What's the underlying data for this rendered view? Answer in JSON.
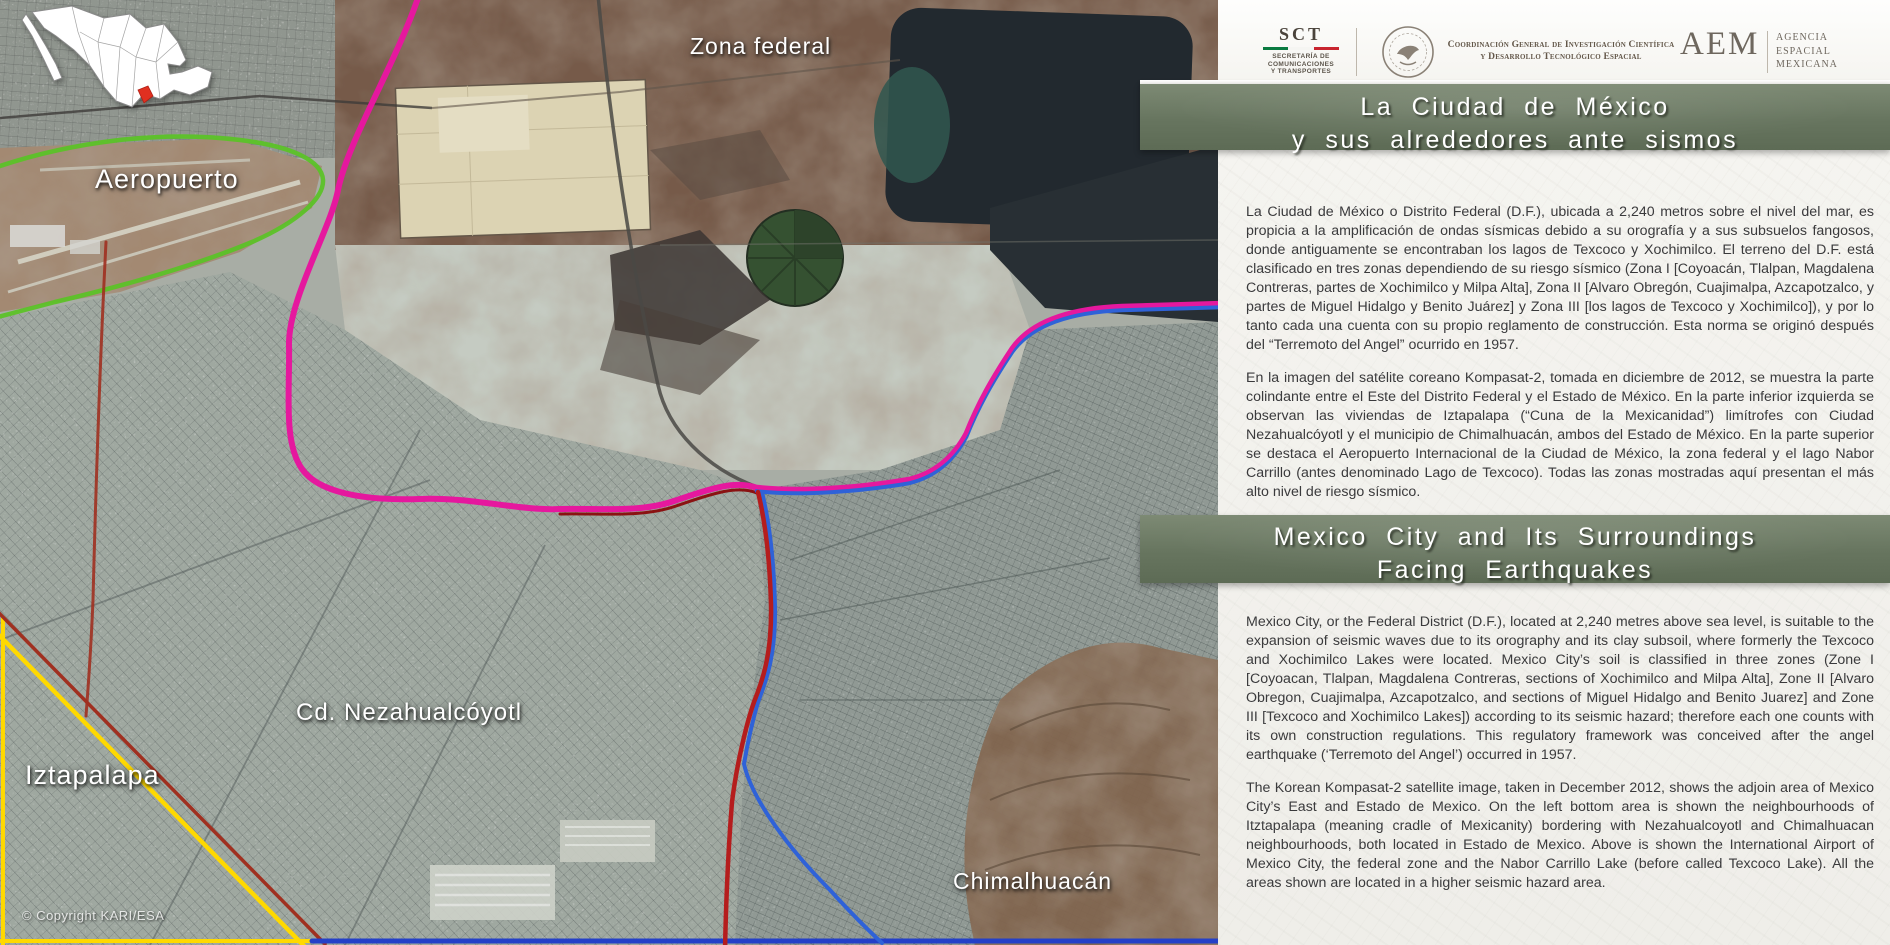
{
  "map": {
    "labels": {
      "zona_federal": "Zona federal",
      "aeropuerto": "Aeropuerto",
      "iztapalapa": "Iztapalapa",
      "nezahualcoyotl": "Cd. Nezahualcóyotl",
      "chimalhuacan": "Chimalhuacán"
    },
    "copyright": "© Copyright KARI/ESA",
    "inset": "mexico-country-inset-map-with-highlighted-state",
    "line_colors": {
      "airport_boundary_green": "#5cc228",
      "federal_zone_magenta": "#e5189e",
      "state_limit_blue": "#2f62d8",
      "state_limit_red": "#b51d1d",
      "iztapalapa_limit_yellow": "#ffd900"
    }
  },
  "panel": {
    "header": {
      "sct": {
        "acronym": "SCT",
        "lines": [
          "SECRETARÍA DE",
          "COMUNICACIONES",
          "Y TRANSPORTES"
        ],
        "flag_colors": [
          "#0a7a40",
          "#f5f5f2",
          "#c8242e"
        ]
      },
      "coordination": {
        "line1": "Coordinación General de Investigación Científica",
        "line2": "y Desarrollo Tecnológico Espacial"
      },
      "aem": {
        "acronym": "AEM",
        "lines": [
          "AGENCIA",
          "ESPACIAL",
          "MEXICANA"
        ]
      }
    },
    "titles": {
      "es": {
        "line1": "La Ciudad de México",
        "line2": "y sus alrededores ante sismos"
      },
      "en": {
        "line1": "Mexico City and Its Surroundings",
        "line2": "Facing Earthquakes"
      }
    },
    "body_es": {
      "p1": "La Ciudad de México o Distrito Federal (D.F.), ubicada a 2,240 metros sobre el nivel del mar, es propicia a la amplificación de ondas sísmicas debido a su orografía y a sus subsuelos fangosos, donde antiguamente se encontraban los lagos de Texcoco y Xochimilco. El terreno del D.F. está clasificado en tres zonas dependiendo de su riesgo sísmico (Zona I [Coyoacán, Tlalpan, Magdalena Contreras, partes de Xochimilco y Milpa Alta], Zona II [Alvaro Obregón, Cuajimalpa, Azcapotzalco, y partes de Miguel Hidalgo y Benito Juárez] y Zona III [los lagos de Texcoco y Xochimilco]), y por lo tanto cada una cuenta con su propio reglamento de construcción. Esta norma se originó después del “Terremoto del Angel” ocurrido en 1957.",
      "p2": "En la imagen del satélite coreano Kompasat-2, tomada en diciembre de 2012, se muestra la parte colindante entre el Este del Distrito Federal y el Estado de México. En la parte inferior izquierda se observan las viviendas de Iztapalapa (“Cuna de la Mexicanidad”) limítrofes con Ciudad Nezahualcóyotl y el municipio de Chimalhuacán, ambos del Estado de México. En la parte superior se destaca el Aeropuerto Internacional de la Ciudad de México, la zona federal y el lago Nabor Carrillo (antes denominado Lago de Texcoco). Todas las zonas mostradas aquí presentan el más alto nivel de riesgo sísmico."
    },
    "body_en": {
      "p1": "Mexico City, or the Federal District (D.F.), located at 2,240 metres above sea level, is suitable to the expansion of seismic waves due to its orography and its clay subsoil, where formerly the Texcoco and Xochimilco Lakes were located. Mexico City’s soil is classified in three zones (Zone I [Coyoacan, Tlalpan, Magdalena Contreras, sections of Xochimilco and Milpa Alta], Zone II [Alvaro Obregon, Cuajimalpa, Azcapotzalco, and sections of Miguel Hidalgo and Benito Juarez] and Zone III [Texcoco and Xochimilco Lakes]) according to its seismic hazard; therefore each one counts with its own construction regulations. This regulatory framework was conceived after the angel earthquake (‘Terremoto del Angel’) occurred in 1957.",
      "p2": "The Korean Kompasat-2 satellite image, taken in December 2012, shows the adjoin area of Mexico City’s East and Estado de Mexico. On the left bottom area is shown the neighbourhoods of Itztapalapa (meaning cradle of Mexicanity) bordering with Nezahualcoyotl and Chimalhuacan neighbourhoods, both located in Estado de Mexico. Above is shown the International Airport of Mexico City, the federal zone and the Nabor Carrillo Lake (before called Texcoco Lake). All the areas shown are located in a higher seismic hazard area."
    }
  },
  "colors": {
    "banner_green": "#67755f",
    "panel_bg": "#f2f1ec",
    "body_text": "#3a3a3c",
    "lake": "#0e151c"
  }
}
